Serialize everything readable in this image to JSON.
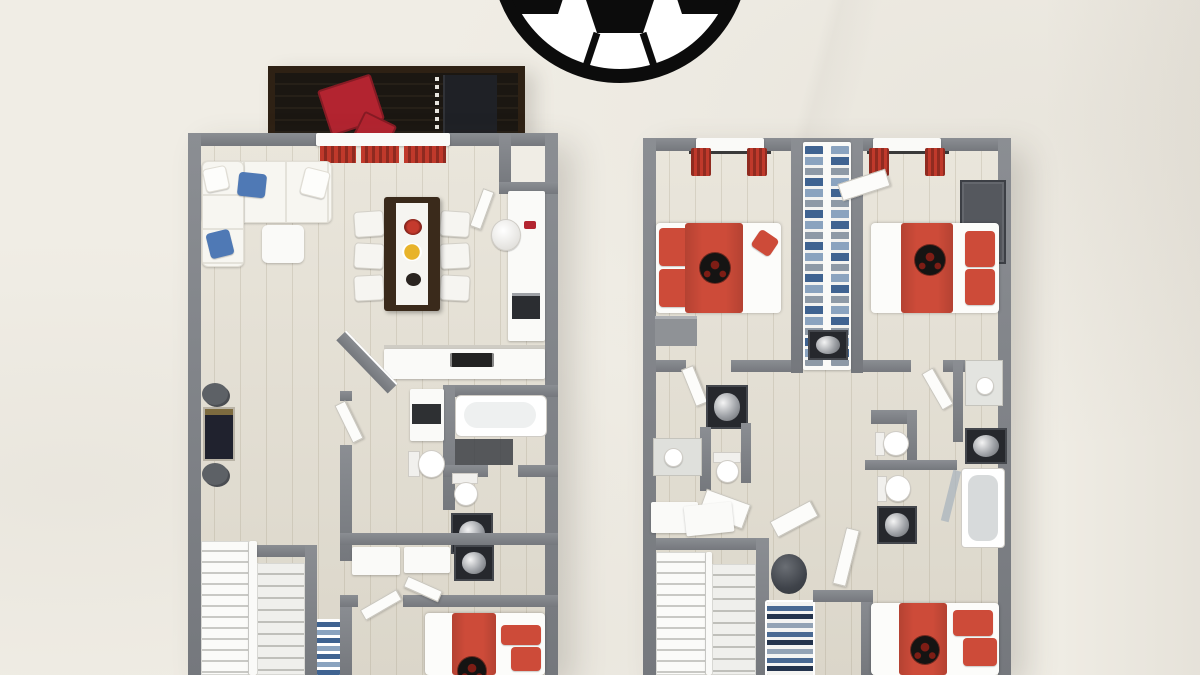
{
  "scene": {
    "type": "3d-floor-plan",
    "description": "Two soccer-themed apartment floor plans rendered in 3D top-down view on a cream textured backdrop, with a large soccer ball graphic at the top center",
    "text_visible": "none",
    "decor": {
      "soccer_ball_graphic": "bottom half of black-and-white soccer ball at top center",
      "soccer_ball_motifs_on_beds": 4
    }
  },
  "colors": {
    "background": "#f0ede5",
    "wall": "#75787d",
    "wall_light": "#8b8e93",
    "floor": "#e4dfd2",
    "white": "#fafaf8",
    "red": "#cd4b39",
    "red_deep": "#b32430",
    "red_curtain": "#c0392b",
    "blue": "#4f79b5",
    "denim": "#3f6391",
    "denim_light": "#8aa3bf",
    "wood_dark": "#3a2a1b",
    "deck": "#1a1510",
    "deck_frame": "#2e2114",
    "dark_unit": "#1f2126",
    "ball_black": "#0c0c0c",
    "shadow": "rgba(60,55,45,0.18)"
  },
  "floor_plan_left": {
    "name": "first-floor",
    "rooms": [
      {
        "name": "balcony",
        "items": [
          "red-lounge-chairs",
          "dark-storage-unit",
          "wood-deck"
        ]
      },
      {
        "name": "living-room",
        "items": [
          "white-corner-sofa",
          "blue-cushions",
          "ottoman"
        ]
      },
      {
        "name": "dining-area",
        "items": [
          "dark-wood-table",
          "six-white-chairs",
          "red-flowers",
          "plates"
        ]
      },
      {
        "name": "kitchen",
        "items": [
          "l-shaped-counter",
          "cooktop",
          "oven",
          "round-sink"
        ]
      },
      {
        "name": "game-corner",
        "items": [
          "arcade-table",
          "two-stools"
        ]
      },
      {
        "name": "bathroom",
        "items": [
          "bathtub",
          "shower",
          "toilet"
        ]
      },
      {
        "name": "laundry-wc",
        "items": [
          "washer-dryer-tower",
          "toilet",
          "washing-machine",
          "cabinets"
        ]
      },
      {
        "name": "staircase",
        "items": [
          "double-flight-stairs"
        ]
      },
      {
        "name": "closet",
        "items": [
          "shelves-with-clothes"
        ]
      },
      {
        "name": "bedroom",
        "items": [
          "double-bed-red-soccer",
          "red-pillows"
        ]
      }
    ]
  },
  "floor_plan_right": {
    "name": "second-floor",
    "rooms": [
      {
        "name": "bedroom-top-left",
        "items": [
          "double-bed-red-soccer",
          "red-curtained-window",
          "gray-nightstand",
          "red-cushion"
        ]
      },
      {
        "name": "bedroom-top-right",
        "items": [
          "double-bed-red-soccer",
          "red-curtained-window",
          "dark-wardrobe"
        ]
      },
      {
        "name": "walk-in-closet",
        "items": [
          "shelves-with-blue-clothes",
          "lower-wardrobe"
        ]
      },
      {
        "name": "bathroom-left",
        "items": [
          "washer",
          "sink-counter",
          "toilet",
          "window-bench"
        ]
      },
      {
        "name": "bathroom-right",
        "items": [
          "sink-counter",
          "two-toilets",
          "two-washers",
          "shower-enclosure"
        ]
      },
      {
        "name": "staircase",
        "items": [
          "double-flight-stairs"
        ]
      },
      {
        "name": "landing",
        "items": [
          "bean-bag",
          "shoe-shelf",
          "white-table"
        ]
      },
      {
        "name": "bedroom-bottom",
        "items": [
          "double-bed-red-soccer",
          "red-pillows"
        ]
      }
    ]
  }
}
